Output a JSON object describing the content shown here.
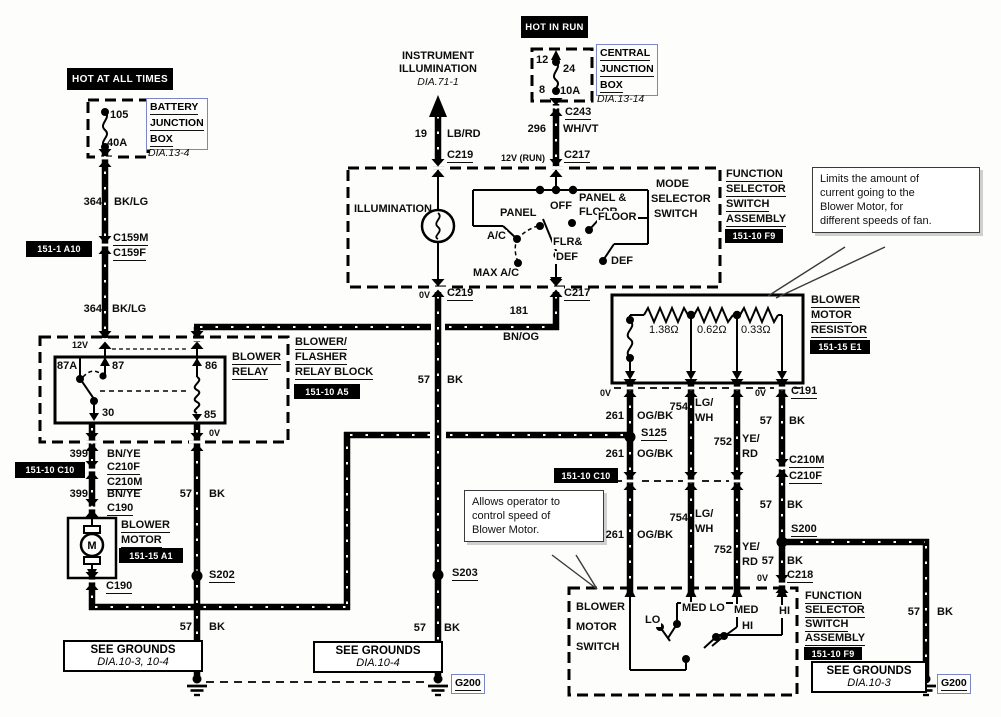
{
  "banners": {
    "hot_at_all_times": "HOT AT ALL TIMES",
    "hot_in_run": "HOT IN RUN"
  },
  "bjb": {
    "l1": "BATTERY",
    "l2": "JUNCTION",
    "l3": "BOX",
    "dia": "DIA.13-4",
    "fuse_id": "105",
    "fuse_rating": "40A"
  },
  "cjb": {
    "l1": "CENTRAL",
    "l2": "JUNCTION",
    "l3": "BOX",
    "dia": "DIA.13-14",
    "pin_top": "12",
    "pin_bottom": "8",
    "fuse_id": "24",
    "fuse_rating": "10A"
  },
  "instrument": {
    "l1": "INSTRUMENT",
    "l2": "ILLUMINATION",
    "dia": "DIA.71-1"
  },
  "volts": {
    "v12": "12V",
    "v0": "0V",
    "v12run": "12V (RUN)"
  },
  "wires": {
    "batt": {
      "num": "364",
      "color": "BK/LG"
    },
    "illum": {
      "num": "19",
      "color": "LB/RD"
    },
    "ign": {
      "num": "296",
      "color": "WH/VT"
    },
    "relay_coil": {
      "num": "181",
      "color": "BN/OG"
    },
    "motor_feed": {
      "num": "399",
      "color": "BN/YE"
    },
    "motor_return": {
      "num": "261",
      "color": "OG/BK"
    },
    "med_lo": {
      "num": "754",
      "c1": "LG/",
      "c2": "WH"
    },
    "med_hi": {
      "num": "752",
      "c1": "YE/",
      "c2": "RD"
    },
    "ground": {
      "num": "57",
      "color": "BK"
    }
  },
  "connectors": {
    "c159m": "C159M",
    "c159f": "C159F",
    "c219": "C219",
    "c217": "C217",
    "c243": "C243",
    "c191": "C191",
    "c210m": "C210M",
    "c210f": "C210F",
    "c190": "C190",
    "c218": "C218"
  },
  "splices": {
    "s125": "S125",
    "s200": "S200",
    "s202": "S202",
    "s203": "S203"
  },
  "grounds": {
    "g200": "G200",
    "left": {
      "l1": "SEE GROUNDS",
      "l2": "DIA.10-3, 10-4"
    },
    "mid": {
      "l1": "SEE GROUNDS",
      "l2": "DIA.10-4"
    },
    "right": {
      "l1": "SEE GROUNDS",
      "l2": "DIA.10-3"
    }
  },
  "refs": {
    "a10": "151-1 A10",
    "a5": "151-10 A5",
    "c10": "151-10 C10",
    "a1": "151-15 A1",
    "e1": "151-15 E1",
    "f9": "151-10 F9"
  },
  "relay": {
    "t1": "BLOWER",
    "t2": "RELAY",
    "b1": "BLOWER/",
    "b2": "FLASHER",
    "b3": "RELAY BLOCK",
    "p87a": "87A",
    "p87": "87",
    "p86": "86",
    "p30": "30",
    "p85": "85"
  },
  "motor": {
    "l1": "BLOWER",
    "l2": "MOTOR",
    "symbol": "M"
  },
  "resistor": {
    "l1": "BLOWER",
    "l2": "MOTOR",
    "l3": "RESISTOR",
    "r1": "1.38Ω",
    "r2": "0.62Ω",
    "r3": "0.33Ω"
  },
  "selector": {
    "illumination": "ILLUMINATION",
    "m1": "MODE",
    "m2": "SELECTOR",
    "m3": "SWITCH",
    "panel": "PANEL",
    "off": "OFF",
    "pf1": "PANEL &",
    "pf2": "FLOOR",
    "ac": "A/C",
    "max_ac": "MAX A/C",
    "fd1": "FLR&",
    "fd2": "DEF",
    "floor": "FLOOR",
    "def": "DEF"
  },
  "fssa": {
    "l1": "FUNCTION",
    "l2": "SELECTOR",
    "l3": "SWITCH",
    "l4": "ASSEMBLY"
  },
  "blower_switch": {
    "l1": "BLOWER",
    "l2": "MOTOR",
    "l3": "SWITCH",
    "lo": "LO",
    "med_lo": "MED LO",
    "mh1": "MED",
    "mh2": "HI",
    "hi": "HI"
  },
  "notes": {
    "resistor": {
      "l1": "Limits the amount of",
      "l2": "current going to the",
      "l3": "Blower Motor, for",
      "l4": "different speeds of fan."
    },
    "switch": {
      "l1": "Allows operator to",
      "l2": "control speed of",
      "l3": "Blower Motor."
    }
  },
  "colors": {
    "link_blue": "#7b86c8",
    "wire_black": "#000000"
  }
}
